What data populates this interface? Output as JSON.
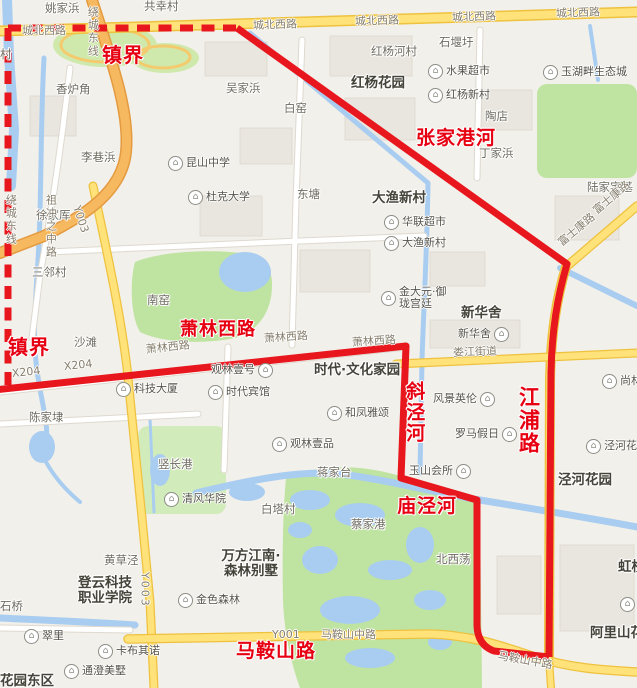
{
  "map": {
    "colors": {
      "boundary_red": "#e8161d",
      "label_red": "#e60012",
      "road_yellow": "#ffe27a",
      "road_yellow_edge": "#eec23f",
      "highway_orange": "#f6b95f",
      "water_blue": "#a9cdf0",
      "park_green": "#bfe3a0",
      "background": "#f2f0ea"
    },
    "boundary_labels": [
      {
        "text": "镇界",
        "x": 102,
        "y": 44,
        "size": 20
      },
      {
        "text": "镇界",
        "x": 8,
        "y": 336,
        "size": 20
      },
      {
        "text": "张家港河",
        "x": 416,
        "y": 128
      },
      {
        "text": "萧林西路",
        "x": 180,
        "y": 320,
        "size": 18
      },
      {
        "text": "斜泾河",
        "x": 403,
        "y": 381,
        "v": 1
      },
      {
        "text": "江浦路",
        "x": 516,
        "y": 386,
        "v": 1,
        "size": 21
      },
      {
        "text": "庙泾河",
        "x": 397,
        "y": 496
      },
      {
        "text": "马鞍山路",
        "x": 236,
        "y": 641
      }
    ],
    "area_labels": [
      {
        "text": "红杨花园",
        "x": 351,
        "y": 76
      },
      {
        "text": "大渔新村",
        "x": 372,
        "y": 191
      },
      {
        "text": "新华舍",
        "x": 461,
        "y": 306
      },
      {
        "text": "时代·文化家园",
        "x": 314,
        "y": 363
      },
      {
        "text": "泾河花园",
        "x": 558,
        "y": 473
      },
      {
        "text": "登云科技职业学院",
        "x": 76,
        "y": 576,
        "w": 58
      },
      {
        "text": "万方江南·森林别墅",
        "x": 215,
        "y": 549,
        "w": 72
      },
      {
        "text": "阿里山花园",
        "x": 590,
        "y": 626
      },
      {
        "text": "虹桥",
        "x": 618,
        "y": 560
      },
      {
        "text": "花园东区",
        "x": 0,
        "y": 674
      }
    ],
    "village_labels": [
      {
        "text": "姚家浜",
        "x": 45,
        "y": 2
      },
      {
        "text": "共幸村",
        "x": 144,
        "y": 0
      },
      {
        "text": "村",
        "x": 0,
        "y": 48
      },
      {
        "text": "香炉角",
        "x": 56,
        "y": 83
      },
      {
        "text": "李巷浜",
        "x": 81,
        "y": 151
      },
      {
        "text": "吴家浜",
        "x": 226,
        "y": 82
      },
      {
        "text": "白窑",
        "x": 284,
        "y": 102
      },
      {
        "text": "石堰圩",
        "x": 439,
        "y": 36
      },
      {
        "text": "红杨河村",
        "x": 371,
        "y": 45
      },
      {
        "text": "陶店",
        "x": 485,
        "y": 110
      },
      {
        "text": "丁家浜",
        "x": 479,
        "y": 147
      },
      {
        "text": "陆家宅基",
        "x": 587,
        "y": 181
      },
      {
        "text": "东塘",
        "x": 297,
        "y": 188
      },
      {
        "text": "徐家厍",
        "x": 36,
        "y": 209
      },
      {
        "text": "三邻村",
        "x": 32,
        "y": 266
      },
      {
        "text": "南窑",
        "x": 147,
        "y": 294
      },
      {
        "text": "沙滩",
        "x": 74,
        "y": 336
      },
      {
        "text": "陈家埭",
        "x": 29,
        "y": 411
      },
      {
        "text": "竖长港",
        "x": 158,
        "y": 458
      },
      {
        "text": "蒋家台",
        "x": 317,
        "y": 466
      },
      {
        "text": "白塔村",
        "x": 261,
        "y": 503
      },
      {
        "text": "蔡家港",
        "x": 351,
        "y": 518
      },
      {
        "text": "北西荡",
        "x": 436,
        "y": 553
      },
      {
        "text": "黄草泾",
        "x": 104,
        "y": 554
      },
      {
        "text": "石桥",
        "x": 0,
        "y": 600
      }
    ],
    "road_labels": [
      {
        "text": "城北西路",
        "x": 22,
        "y": 25
      },
      {
        "text": "城北西路",
        "x": 253,
        "y": 20,
        "r": -2
      },
      {
        "text": "城北西路",
        "x": 355,
        "y": 16,
        "r": -2
      },
      {
        "text": "城北西路",
        "x": 452,
        "y": 12,
        "r": -2
      },
      {
        "text": "城北西路",
        "x": 556,
        "y": 8,
        "r": -2
      },
      {
        "text": "绕城东线",
        "x": 86,
        "y": 6,
        "v": 1
      },
      {
        "text": "绕城东线",
        "x": 4,
        "y": 194,
        "v": 1
      },
      {
        "text": "Y003",
        "x": 76,
        "y": 200,
        "r": 72
      },
      {
        "text": "Y003",
        "x": 138,
        "y": 572,
        "v": 1
      },
      {
        "text": "X204",
        "x": 12,
        "y": 368,
        "r": -6
      },
      {
        "text": "X204",
        "x": 64,
        "y": 361,
        "r": -6
      },
      {
        "text": "萧林西路",
        "x": 146,
        "y": 344,
        "r": -6
      },
      {
        "text": "萧林西路",
        "x": 264,
        "y": 333,
        "r": -4
      },
      {
        "text": "萧林西路",
        "x": 352,
        "y": 337,
        "r": -4
      },
      {
        "text": "娄江街道",
        "x": 453,
        "y": 347,
        "r": -2
      },
      {
        "text": "富士康路",
        "x": 560,
        "y": 238,
        "r": -40
      },
      {
        "text": "富士康路",
        "x": 595,
        "y": 206,
        "r": -40
      },
      {
        "text": "祖冲之中路",
        "x": 44,
        "y": 194,
        "v": 1
      },
      {
        "text": "Y001",
        "x": 272,
        "y": 629
      },
      {
        "text": "马鞍山中路",
        "x": 321,
        "y": 629
      },
      {
        "text": "马鞍山中路",
        "x": 498,
        "y": 650,
        "r": 10
      }
    ],
    "pois": [
      {
        "text": "水果超市",
        "x": 428,
        "y": 64,
        "side": "left"
      },
      {
        "text": "玉湖畔生态城",
        "x": 543,
        "y": 65,
        "side": "left"
      },
      {
        "text": "红杨新村",
        "x": 428,
        "y": 88,
        "side": "left"
      },
      {
        "text": "昆山中学",
        "x": 168,
        "y": 156,
        "side": "left"
      },
      {
        "text": "杜克大学",
        "x": 188,
        "y": 190,
        "side": "left"
      },
      {
        "text": "华联超市",
        "x": 384,
        "y": 215,
        "side": "left"
      },
      {
        "text": "大渔新村",
        "x": 384,
        "y": 236,
        "side": "left"
      },
      {
        "text": "金大元·御珑宫廷",
        "x": 381,
        "y": 286,
        "side": "left",
        "w": 58
      },
      {
        "text": "新华舍",
        "x": 458,
        "y": 327,
        "side": "right"
      },
      {
        "text": "科技大厦",
        "x": 116,
        "y": 382,
        "side": "left"
      },
      {
        "text": "观林壹号",
        "x": 211,
        "y": 363,
        "side": "right"
      },
      {
        "text": "时代宾馆",
        "x": 208,
        "y": 385,
        "side": "left"
      },
      {
        "text": "和凤雅颂",
        "x": 327,
        "y": 406,
        "side": "left"
      },
      {
        "text": "观林壹品",
        "x": 272,
        "y": 437,
        "side": "left"
      },
      {
        "text": "风景英伦",
        "x": 433,
        "y": 392,
        "side": "right"
      },
      {
        "text": "罗马假日",
        "x": 455,
        "y": 427,
        "side": "right"
      },
      {
        "text": "玉山会所",
        "x": 409,
        "y": 464,
        "side": "right"
      },
      {
        "text": "尚林",
        "x": 602,
        "y": 374,
        "side": "left"
      },
      {
        "text": "泾河花园",
        "x": 586,
        "y": 439,
        "side": "left"
      },
      {
        "text": "清风华院",
        "x": 164,
        "y": 492,
        "side": "left"
      },
      {
        "text": "金色森林",
        "x": 178,
        "y": 593,
        "side": "left"
      },
      {
        "text": "翠里",
        "x": 24,
        "y": 629,
        "side": "left"
      },
      {
        "text": "卡布其诺",
        "x": 98,
        "y": 644,
        "side": "left"
      },
      {
        "text": "通澄美墅",
        "x": 64,
        "y": 664,
        "side": "left"
      },
      {
        "text": "",
        "x": 620,
        "y": 597,
        "side": "left"
      }
    ]
  }
}
